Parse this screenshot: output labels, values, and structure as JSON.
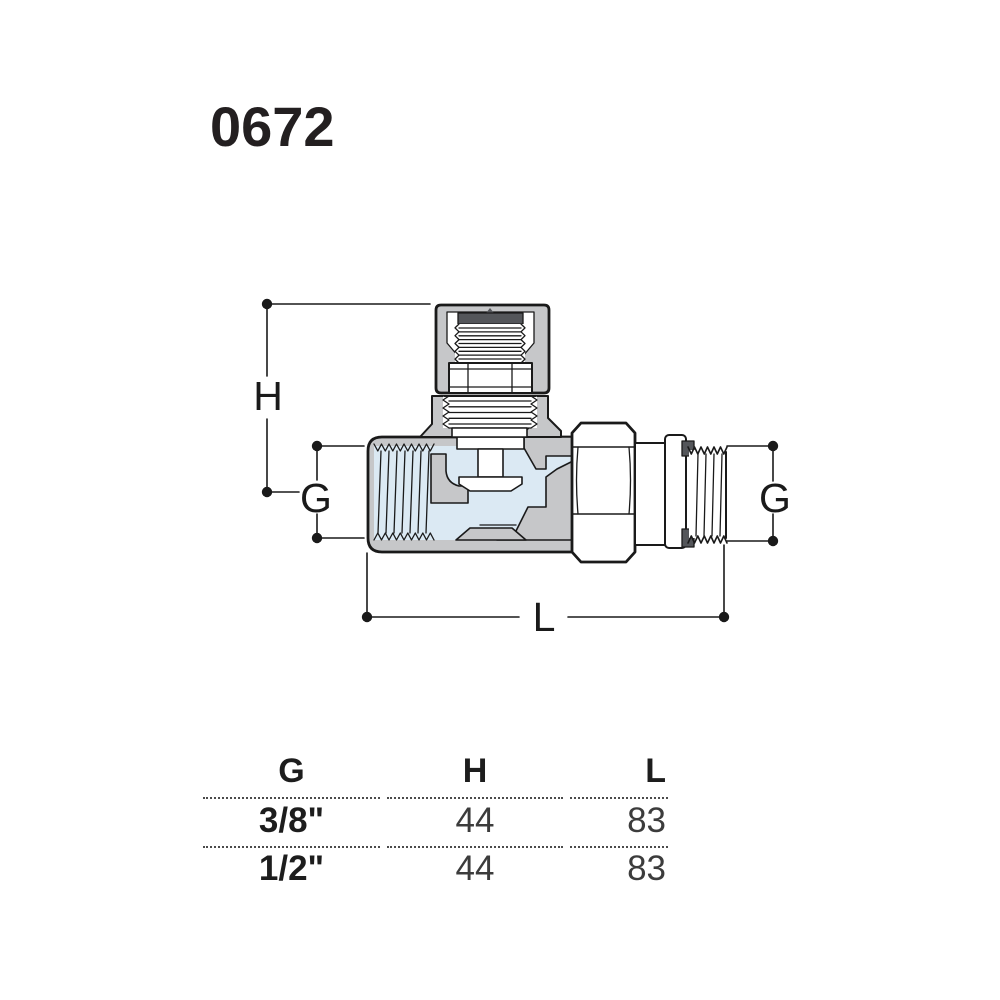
{
  "title": "0672",
  "drawing": {
    "dim_labels": {
      "h": "H",
      "g_left": "G",
      "g_right": "G",
      "l": "L"
    },
    "colors": {
      "metal_gray": "#c6c7c9",
      "fluid_blue": "#dbe9f3",
      "dark_gray": "#54565a",
      "outline": "#1a1a1a"
    }
  },
  "table": {
    "headers": [
      "G",
      "H",
      "L"
    ],
    "rows": [
      [
        "3/8\"",
        "44",
        "83"
      ],
      [
        "1/2\"",
        "44",
        "83"
      ]
    ]
  }
}
